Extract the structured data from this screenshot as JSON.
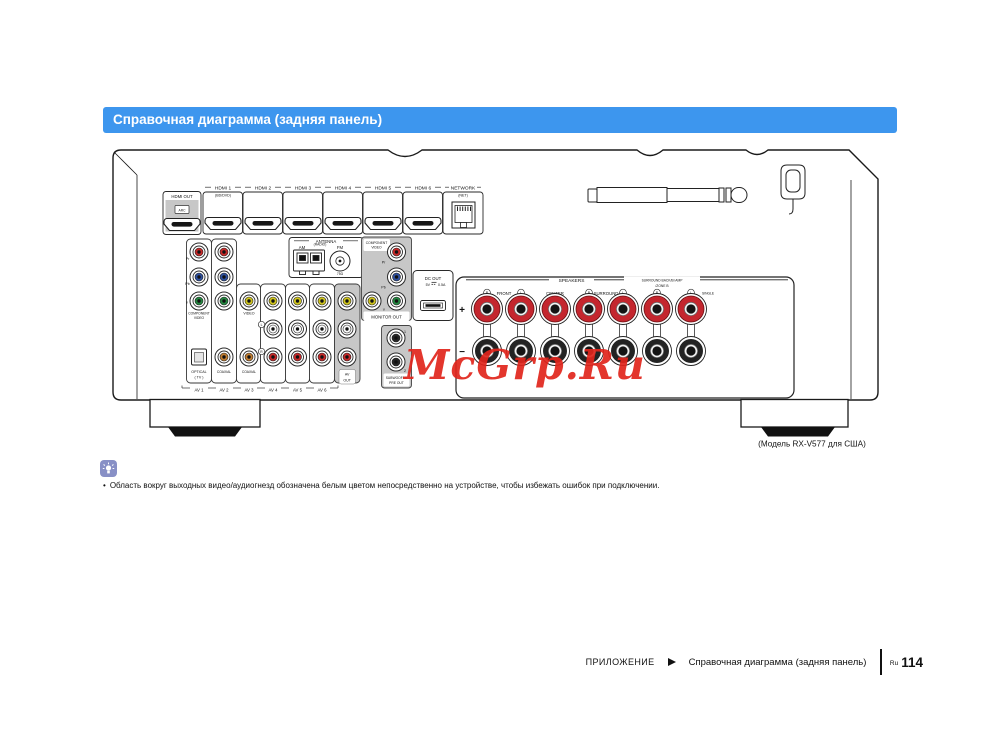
{
  "header": {
    "title": "Справочная диаграмма (задняя панель)"
  },
  "watermark": "McGrp.Ru",
  "diagram": {
    "caption": "(Модель RX-V577 для США)",
    "hdmi": {
      "out": "HDMI OUT",
      "arc": "ARC",
      "inputs": [
        "HDMI 1",
        "HDMI 2",
        "HDMI 3",
        "HDMI 4",
        "HDMI 5",
        "HDMI 6"
      ],
      "input1_sub": "(BD/DVD)",
      "network": "NETWORK",
      "network_sub": "(NET)"
    },
    "antenna": {
      "title": "ANTENNA",
      "am": "AM",
      "radio": "(RADIO)",
      "fm": "FM",
      "ohm": "75Ω"
    },
    "jacks": {
      "pr": "Pr",
      "pb": "Pb",
      "y": "Y",
      "component_1": "COMPONENT",
      "component_2": "VIDEO",
      "video": "VIDEO",
      "optical": "OPTICAL",
      "optical_sub": "( TV )",
      "coaxial": "COAXIAL",
      "l": "L",
      "r": "R",
      "av": [
        "AV 1",
        "AV 2",
        "AV 3",
        "AV 4",
        "AV 5",
        "AV 6"
      ],
      "av_out_1": "AV",
      "av_out_2": "OUT",
      "monitor_out": "MONITOR OUT",
      "sub_1": "SUBWOOFER",
      "sub_2": "PRE OUT",
      "sub_n1": "1",
      "sub_n2": "2"
    },
    "dc": {
      "label": "DC OUT",
      "volt": "5V",
      "amp": "0.5A"
    },
    "speakers": {
      "title": "SPEAKERS",
      "front": "FRONT",
      "center": "CENTER",
      "surround": "SURROUND",
      "sb1": "SURROUND BACK/BI AMP",
      "sb2": "/ZONE B",
      "single": "SINGLE",
      "r": "R",
      "l": "L",
      "plus": "+",
      "minus": "−"
    }
  },
  "note": {
    "bullet": "•",
    "text": "Область вокруг выходных видео/аудиогнезд обозначена белым цветом непосредственно на устройстве, чтобы избежать ошибок при подключении."
  },
  "footer": {
    "section": "ПРИЛОЖЕНИЕ",
    "arrow_icon": "right-arrowhead",
    "title": "Справочная диаграмма (задняя панель)",
    "lang": "Ru",
    "page": "114"
  },
  "colors": {
    "accent_blue": "#3d96ee",
    "watermark_red": "#e1251c",
    "jack_red": "#c62828",
    "jack_blue": "#2d4f9e",
    "jack_green": "#23853f",
    "jack_yellow": "#cfc41e",
    "jack_orange": "#c07c30",
    "panel_gray": "#c7c7c7",
    "note_icon_bg": "#8890c6"
  }
}
